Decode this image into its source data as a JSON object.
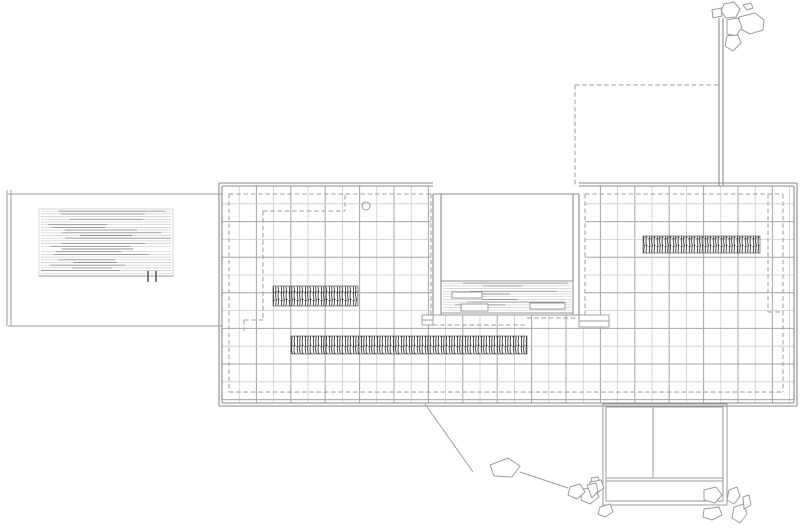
{
  "plan": {
    "width": 800,
    "height": 530,
    "bg": "#ffffff",
    "colors": {
      "edge": "#8a8a8a",
      "grid_major": "#a4a4a4",
      "grid_minor": "#cbcbcb",
      "dashed": "#9a9a9a",
      "wall_scribble": "#222222",
      "water_light": "#cccccc",
      "water_dark": "#8f8f8f",
      "rock_outline": "#9a9a9a",
      "tick": "#555555"
    },
    "slab": {
      "inner": [
        222,
        186,
        794,
        403
      ],
      "outer": [
        219,
        183,
        797,
        406
      ],
      "notch": [
        431,
        186,
        585,
        315
      ],
      "top_break": [
        433,
        579
      ],
      "grid": {
        "col0": 222,
        "col_step": 17.2,
        "row0": 186,
        "row_step": 17.8
      }
    },
    "courtyard": {
      "north_line": [
        433,
        194,
        579,
        194
      ],
      "west_wall_x": [
        433,
        441
      ],
      "east_wall_x": [
        573,
        579
      ],
      "wall_y": [
        194,
        315
      ],
      "pool": [
        441,
        281,
        573,
        313
      ],
      "stones": [
        [
          452,
          292,
          30,
          6
        ],
        [
          461,
          304,
          27,
          7
        ],
        [
          530,
          303,
          35,
          6
        ]
      ],
      "bottom_line": [
        433,
        315,
        585,
        315
      ],
      "steps": [
        [
          422,
          315,
          11,
          10
        ],
        [
          579,
          315,
          30,
          12
        ]
      ]
    },
    "left_terrace": {
      "top": [
        8,
        194,
        222,
        194
      ],
      "bottom": [
        8,
        326,
        222,
        326
      ],
      "left_x": [
        7,
        11
      ],
      "left_y": [
        190,
        326
      ],
      "pool": [
        39,
        209,
        173,
        276
      ],
      "ticks": [
        [
          148,
          271,
          148,
          282
        ],
        [
          156,
          271,
          156,
          282
        ]
      ]
    },
    "marble_walls": [
      [
        273,
        286,
        85,
        20
      ],
      [
        291,
        336,
        236,
        18
      ],
      [
        643,
        236,
        117,
        17
      ]
    ],
    "free_wall": [
      [
        719,
        18,
        719,
        186
      ],
      [
        723,
        18,
        723,
        186
      ]
    ],
    "circle": [
      366,
      206,
      4
    ],
    "dashed_segments": [
      [
        229,
        194,
        431,
        194
      ],
      [
        585,
        194,
        783,
        194
      ],
      [
        229,
        194,
        229,
        392
      ],
      [
        229,
        392,
        783,
        392
      ],
      [
        783,
        194,
        783,
        392
      ],
      [
        431,
        194,
        431,
        325
      ],
      [
        585,
        194,
        585,
        318
      ],
      [
        433,
        325,
        527,
        325
      ],
      [
        527,
        318,
        585,
        318
      ],
      [
        768,
        194,
        768,
        312
      ],
      [
        768,
        312,
        783,
        312
      ],
      [
        575,
        85,
        719,
        85
      ],
      [
        575,
        85,
        575,
        186
      ],
      [
        345,
        195,
        345,
        211
      ],
      [
        263,
        211,
        345,
        211
      ],
      [
        263,
        211,
        263,
        320
      ],
      [
        244,
        320,
        263,
        320
      ],
      [
        244,
        320,
        244,
        331
      ]
    ],
    "annex": {
      "outer": [
        603,
        404,
        727,
        505
      ],
      "inner": [
        606,
        407,
        723,
        501
      ],
      "divider": [
        653,
        407,
        653,
        478
      ],
      "shelf": [
        [
          606,
          478,
          723,
          478
        ],
        [
          606,
          481,
          723,
          481
        ]
      ]
    },
    "paths": [
      [
        425,
        404,
        473,
        472
      ],
      [
        520,
        472,
        568,
        488
      ]
    ],
    "rocks": {
      "mid": [
        [
          [
            490,
            465
          ],
          [
            508,
            458
          ],
          [
            520,
            466
          ],
          [
            512,
            477
          ],
          [
            494,
            476
          ]
        ]
      ],
      "top_right": [
        [
          [
            739,
            17
          ],
          [
            755,
            13
          ],
          [
            764,
            20
          ],
          [
            763,
            30
          ],
          [
            750,
            34
          ],
          [
            739,
            28
          ]
        ],
        [
          [
            724,
            4
          ],
          [
            734,
            2
          ],
          [
            740,
            9
          ],
          [
            736,
            17
          ],
          [
            726,
            18
          ],
          [
            721,
            11
          ]
        ],
        [
          [
            743,
            5
          ],
          [
            751,
            3
          ],
          [
            753,
            8
          ],
          [
            747,
            10
          ]
        ],
        [
          [
            712,
            10
          ],
          [
            721,
            8
          ],
          [
            722,
            16
          ],
          [
            713,
            18
          ]
        ],
        [
          [
            727,
            20
          ],
          [
            738,
            18
          ],
          [
            742,
            27
          ],
          [
            736,
            36
          ],
          [
            727,
            34
          ]
        ],
        [
          [
            727,
            36
          ],
          [
            738,
            35
          ],
          [
            741,
            43
          ],
          [
            733,
            51
          ],
          [
            725,
            46
          ]
        ]
      ],
      "annex_left": [
        [
          [
            591,
            478
          ],
          [
            598,
            477
          ],
          [
            600,
            482
          ],
          [
            592,
            483
          ]
        ],
        [
          [
            590,
            482
          ],
          [
            601,
            480
          ],
          [
            604,
            488
          ],
          [
            597,
            493
          ],
          [
            589,
            490
          ]
        ],
        [
          [
            582,
            489
          ],
          [
            595,
            488
          ],
          [
            599,
            497
          ],
          [
            590,
            504
          ],
          [
            581,
            500
          ]
        ],
        [
          [
            600,
            507
          ],
          [
            610,
            504
          ],
          [
            613,
            512
          ],
          [
            605,
            517
          ],
          [
            598,
            514
          ]
        ],
        [
          [
            570,
            487
          ],
          [
            580,
            484
          ],
          [
            585,
            492
          ],
          [
            577,
            499
          ],
          [
            568,
            495
          ]
        ],
        [
          [
            587,
            485
          ],
          [
            596,
            483
          ],
          [
            598,
            491
          ],
          [
            592,
            498
          ]
        ]
      ],
      "annex_right": [
        [
          [
            704,
            490
          ],
          [
            716,
            487
          ],
          [
            722,
            495
          ],
          [
            715,
            503
          ],
          [
            704,
            500
          ]
        ],
        [
          [
            729,
            490
          ],
          [
            737,
            487
          ],
          [
            740,
            496
          ],
          [
            734,
            504
          ],
          [
            727,
            500
          ]
        ],
        [
          [
            734,
            507
          ],
          [
            744,
            504
          ],
          [
            747,
            514
          ],
          [
            740,
            523
          ],
          [
            732,
            518
          ]
        ],
        [
          [
            743,
            497
          ],
          [
            749,
            495
          ],
          [
            751,
            505
          ],
          [
            744,
            509
          ]
        ],
        [
          [
            704,
            509
          ],
          [
            719,
            507
          ],
          [
            722,
            515
          ],
          [
            712,
            520
          ],
          [
            703,
            517
          ]
        ]
      ]
    },
    "water": {
      "seed": 13,
      "spacing": 2.7,
      "dark_prob": 0.65,
      "light_prob": 0.85
    }
  }
}
